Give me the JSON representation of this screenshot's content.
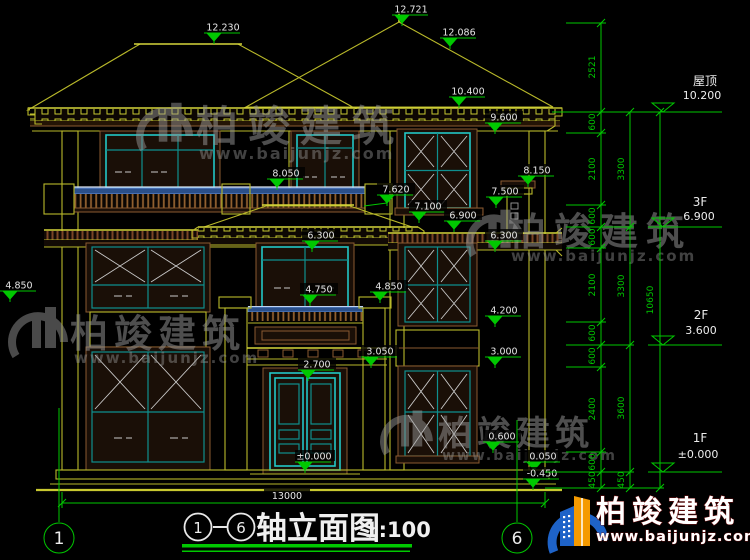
{
  "drawing": {
    "title": {
      "axis_start": "1",
      "axis_end": "6",
      "name": "轴立面图",
      "scale": "1:100"
    },
    "bottom_dimension": "13000",
    "axis_bubbles": {
      "left": "1",
      "right": "6"
    }
  },
  "levels": [
    {
      "name": "屋顶",
      "elev": "10.200"
    },
    {
      "name": "3F",
      "elev": "6.900"
    },
    {
      "name": "2F",
      "elev": "3.600"
    },
    {
      "name": "1F",
      "elev": "±0.000"
    }
  ],
  "markers": [
    {
      "v": "12.230"
    },
    {
      "v": "12.721"
    },
    {
      "v": "12.086"
    },
    {
      "v": "10.400"
    },
    {
      "v": "9.600"
    },
    {
      "v": "8.050"
    },
    {
      "v": "8.150"
    },
    {
      "v": "7.620"
    },
    {
      "v": "7.500"
    },
    {
      "v": "7.100"
    },
    {
      "v": "6.900"
    },
    {
      "v": "6.300"
    },
    {
      "v": "6.300"
    },
    {
      "v": "4.750"
    },
    {
      "v": "4.850"
    },
    {
      "v": "4.850"
    },
    {
      "v": "4.200"
    },
    {
      "v": "3.050"
    },
    {
      "v": "3.000"
    },
    {
      "v": "2.700"
    },
    {
      "v": "0.600"
    },
    {
      "v": "0.050"
    },
    {
      "v": "-0.450"
    },
    {
      "v": "±0.000"
    }
  ],
  "chains": {
    "a": [
      "2521",
      "600",
      "2100",
      "600",
      "600",
      "2100",
      "600",
      "600",
      "2400",
      "600",
      "450"
    ],
    "b": [
      "3300",
      "3300",
      "3600",
      "450"
    ],
    "c": [
      "10650"
    ]
  },
  "watermark": {
    "name": "柏竣建筑",
    "url": "www.baijunjz.com"
  },
  "brand": {
    "name": "柏竣建筑",
    "url": "www.baijunjz.com"
  },
  "colors": {
    "green": "#00c800",
    "yellow": "#b9b92a",
    "cyan": "#22c7c7",
    "brown": "#8a5a30",
    "rail_blue": "#2a4f8a",
    "logo_blue": "#1e63c8",
    "logo_orange": "#f59a00"
  }
}
